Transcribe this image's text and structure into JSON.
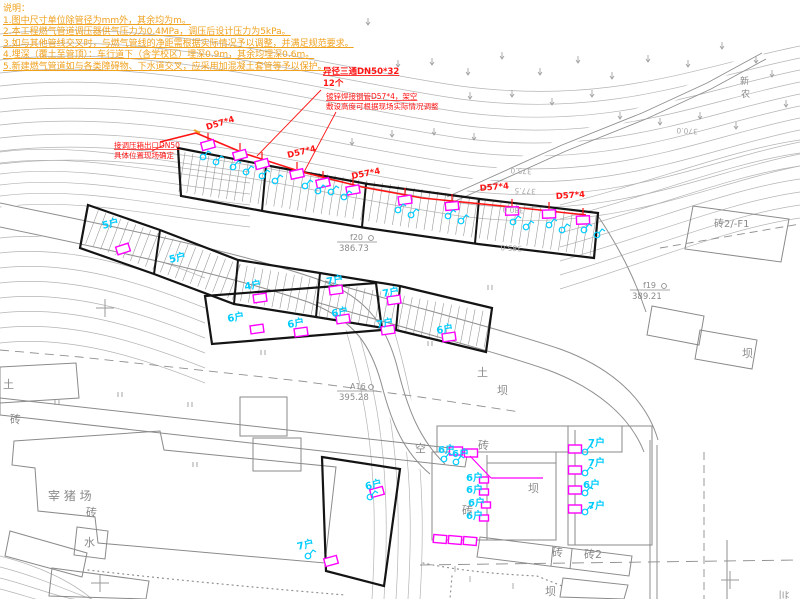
{
  "notes": {
    "header": "说明：",
    "lines": [
      "1.图中尺寸单位除管径为mm外，其余均为m。",
      "2.本工程燃气管道调压器供气压力为0.4MPa，调压后设计压力为5kPa。",
      "3.如与其他管线交叉时，与燃气管线的净距需根据实际情况予以调整，并满足规范要求。",
      "4.埋深（覆土至管顶）：车行道下（含学校区）埋深0.9m，其余均埋深0.6m。",
      "5.新建燃气管道如与各类障碍物、下水道交叉，应采用加混凝土套管等予以保护。"
    ]
  },
  "pipeline": {
    "spec_labels": [
      {
        "text": "D57*4",
        "x": 207,
        "y": 130,
        "rot": -17
      },
      {
        "text": "D57*4",
        "x": 288,
        "y": 158,
        "rot": -14
      },
      {
        "text": "D57*4",
        "x": 352,
        "y": 179,
        "rot": -11
      },
      {
        "text": "D57*4",
        "x": 480,
        "y": 191,
        "rot": -5
      },
      {
        "text": "D57*4",
        "x": 556,
        "y": 199,
        "rot": -4
      }
    ],
    "callouts": {
      "inlet": {
        "lines": [
          "接调压箱出口DN50",
          "具体位置现场确定"
        ],
        "x": 114,
        "y": 148
      },
      "tee": {
        "lines": [
          "异径三通DN50*32",
          "12个"
        ],
        "x": 323,
        "y": 74
      },
      "spec": {
        "lines": [
          "镀锌焊接钢管D57*4，架空",
          "敷设高度可根据现场实际情况调整"
        ],
        "x": 326,
        "y": 99
      }
    }
  },
  "survey_points": [
    {
      "id": "f20",
      "elevation": "386.73",
      "x": 345,
      "y": 240
    },
    {
      "id": "f19",
      "elevation": "389.21",
      "x": 638,
      "y": 288
    },
    {
      "id": "A16",
      "elevation": "395.28",
      "x": 345,
      "y": 389
    }
  ],
  "contour_labels": [
    {
      "text": "375.0",
      "x": 532,
      "y": 169
    },
    {
      "text": "377.5",
      "x": 536,
      "y": 189
    },
    {
      "text": "380.0",
      "x": 524,
      "y": 208
    },
    {
      "text": "385.0",
      "x": 522,
      "y": 246
    },
    {
      "text": "370.0",
      "x": 698,
      "y": 129
    }
  ],
  "map_labels": [
    {
      "text": "砖2/-F1",
      "x": 714,
      "y": 227,
      "size": 10,
      "rot": 0
    },
    {
      "text": "新",
      "x": 740,
      "y": 84,
      "size": 9,
      "rot": 0
    },
    {
      "text": "农",
      "x": 741,
      "y": 97,
      "size": 9,
      "rot": 0
    },
    {
      "text": "土",
      "x": 3,
      "y": 388,
      "size": 11,
      "rot": 0
    },
    {
      "text": "砖",
      "x": 10,
      "y": 423,
      "size": 11,
      "rot": 0
    },
    {
      "text": "宰 猪 场",
      "x": 48,
      "y": 500,
      "size": 12,
      "rot": 0
    },
    {
      "text": "砖",
      "x": 86,
      "y": 516,
      "size": 11,
      "rot": 0
    },
    {
      "text": "水",
      "x": 84,
      "y": 546,
      "size": 11,
      "rot": 0
    },
    {
      "text": "空",
      "x": 415,
      "y": 452,
      "size": 11,
      "rot": 0
    },
    {
      "text": "土",
      "x": 477,
      "y": 376,
      "size": 11,
      "rot": 0
    },
    {
      "text": "坝",
      "x": 497,
      "y": 394,
      "size": 11,
      "rot": 0
    },
    {
      "text": "砖",
      "x": 478,
      "y": 449,
      "size": 11,
      "rot": 0
    },
    {
      "text": "坝",
      "x": 528,
      "y": 492,
      "size": 11,
      "rot": 0
    },
    {
      "text": "砖",
      "x": 462,
      "y": 514,
      "size": 11,
      "rot": 0
    },
    {
      "text": "砖",
      "x": 552,
      "y": 556,
      "size": 11,
      "rot": 0
    },
    {
      "text": "砖2",
      "x": 584,
      "y": 558,
      "size": 11,
      "rot": 0
    },
    {
      "text": "坝",
      "x": 545,
      "y": 595,
      "size": 11,
      "rot": 0
    },
    {
      "text": "坝",
      "x": 742,
      "y": 357,
      "size": 11,
      "rot": 0
    },
    {
      "text": "兰",
      "x": 780,
      "y": 590,
      "size": 10,
      "rot": 90
    }
  ],
  "household_labels": [
    {
      "text": "5户",
      "x": 103,
      "y": 229,
      "rot": -14
    },
    {
      "text": "5户",
      "x": 170,
      "y": 263,
      "rot": -14
    },
    {
      "text": "4户",
      "x": 245,
      "y": 290,
      "rot": -10
    },
    {
      "text": "6户",
      "x": 228,
      "y": 322,
      "rot": -10
    },
    {
      "text": "6户",
      "x": 288,
      "y": 328,
      "rot": -10
    },
    {
      "text": "7户",
      "x": 327,
      "y": 285,
      "rot": -10
    },
    {
      "text": "6户",
      "x": 332,
      "y": 317,
      "rot": -10
    },
    {
      "text": "7户",
      "x": 383,
      "y": 297,
      "rot": -10
    },
    {
      "text": "7户",
      "x": 377,
      "y": 328,
      "rot": -10
    },
    {
      "text": "6户",
      "x": 437,
      "y": 334,
      "rot": -10
    },
    {
      "text": "6户",
      "x": 366,
      "y": 490,
      "rot": -14
    },
    {
      "text": "7户",
      "x": 298,
      "y": 550,
      "rot": -14
    },
    {
      "text": "6户",
      "x": 438,
      "y": 453,
      "rot": 0
    },
    {
      "text": "6户",
      "x": 452,
      "y": 457,
      "rot": 0
    },
    {
      "text": "6户",
      "x": 466,
      "y": 481,
      "rot": 0
    },
    {
      "text": "6户",
      "x": 466,
      "y": 493,
      "rot": 0
    },
    {
      "text": "6户",
      "x": 468,
      "y": 506,
      "rot": 0
    },
    {
      "text": "6户",
      "x": 466,
      "y": 519,
      "rot": 0
    },
    {
      "text": "7户",
      "x": 588,
      "y": 446,
      "rot": 0
    },
    {
      "text": "7户",
      "x": 588,
      "y": 466,
      "rot": 0
    },
    {
      "text": "6户",
      "x": 583,
      "y": 488,
      "rot": 0
    },
    {
      "text": "7户",
      "x": 588,
      "y": 509,
      "rot": 0
    }
  ],
  "meters": {
    "pipeline_boxes": [
      [
        208,
        145,
        -15
      ],
      [
        240,
        155,
        -15
      ],
      [
        262,
        164,
        -15
      ],
      [
        297,
        174,
        -12
      ],
      [
        323,
        183,
        -12
      ],
      [
        353,
        190,
        -10
      ],
      [
        405,
        200,
        -8
      ],
      [
        452,
        206,
        -5
      ],
      [
        512,
        211,
        -2
      ],
      [
        549,
        214,
        -2
      ],
      [
        583,
        220,
        -2
      ]
    ],
    "building_boxes": [
      [
        123,
        249,
        -18
      ],
      [
        260,
        298,
        -8
      ],
      [
        257,
        329,
        -8
      ],
      [
        301,
        332,
        -8
      ],
      [
        336,
        290,
        -8
      ],
      [
        343,
        319,
        -8
      ],
      [
        394,
        300,
        -8
      ],
      [
        388,
        330,
        -8
      ],
      [
        449,
        337,
        -8
      ],
      [
        377,
        492,
        -15
      ],
      [
        331,
        561,
        -15
      ],
      [
        456,
        451,
        0
      ],
      [
        471,
        453,
        0
      ],
      [
        575,
        449,
        0
      ],
      [
        575,
        470,
        0
      ],
      [
        575,
        490,
        0
      ],
      [
        575,
        509,
        0
      ],
      [
        440,
        539,
        5
      ],
      [
        455,
        540,
        5
      ],
      [
        470,
        541,
        5
      ]
    ],
    "small_boxes": [
      [
        484,
        480
      ],
      [
        484,
        492
      ],
      [
        486,
        505
      ],
      [
        484,
        518
      ]
    ]
  },
  "magenta_lines": [
    [
      470,
      456,
      491,
      478
    ],
    [
      491,
      478,
      543,
      478
    ]
  ],
  "risers": [
    [
      203,
      157
    ],
    [
      216,
      162
    ],
    [
      233,
      167
    ],
    [
      246,
      172
    ],
    [
      262,
      176
    ],
    [
      275,
      181
    ],
    [
      305,
      186
    ],
    [
      318,
      191
    ],
    [
      331,
      192
    ],
    [
      344,
      197
    ],
    [
      398,
      210
    ],
    [
      411,
      215
    ],
    [
      448,
      216
    ],
    [
      461,
      221
    ],
    [
      513,
      222
    ],
    [
      526,
      227
    ],
    [
      549,
      225
    ],
    [
      562,
      230
    ],
    [
      584,
      230
    ],
    [
      597,
      235
    ],
    [
      370,
      497
    ],
    [
      308,
      556
    ],
    [
      444,
      459
    ],
    [
      456,
      462
    ],
    [
      585,
      452
    ],
    [
      585,
      473
    ],
    [
      585,
      493
    ],
    [
      585,
      512
    ]
  ],
  "slope_marks": [
    [
      368,
      18
    ],
    [
      398,
      60
    ],
    [
      432,
      58
    ],
    [
      468,
      68
    ],
    [
      502,
      52
    ],
    [
      540,
      68
    ],
    [
      578,
      56
    ],
    [
      612,
      72
    ],
    [
      648,
      55
    ],
    [
      688,
      60
    ],
    [
      722,
      42
    ],
    [
      756,
      56
    ],
    [
      470,
      92
    ],
    [
      512,
      90
    ],
    [
      552,
      98
    ],
    [
      592,
      90
    ],
    [
      352,
      138
    ],
    [
      392,
      130
    ],
    [
      434,
      128
    ],
    [
      474,
      133
    ],
    [
      620,
      112
    ],
    [
      660,
      118
    ],
    [
      700,
      112
    ],
    [
      736,
      122
    ],
    [
      772,
      70
    ],
    [
      786,
      100
    ]
  ],
  "field_marks": [
    [
      55,
      400
    ],
    [
      118,
      392
    ],
    [
      188,
      402
    ],
    [
      193,
      462
    ],
    [
      428,
      341
    ],
    [
      488,
      285
    ],
    [
      261,
      350
    ]
  ],
  "grass_marks": [
    [
      455,
      572
    ],
    [
      470,
      582
    ],
    [
      513,
      589
    ]
  ],
  "grid_crosses": [
    [
      105,
      308
    ],
    [
      100,
      583
    ],
    [
      730,
      580
    ]
  ],
  "colors": {
    "contour": "#b4b4b4",
    "road": "#8f8f8f",
    "building": "#8a8a8a",
    "outline": "#141414",
    "pipe": "#ff1414",
    "meter": "#ff00ff",
    "household": "#00ccff",
    "notes": "#f0a11e",
    "label": "#8a8a8a"
  }
}
